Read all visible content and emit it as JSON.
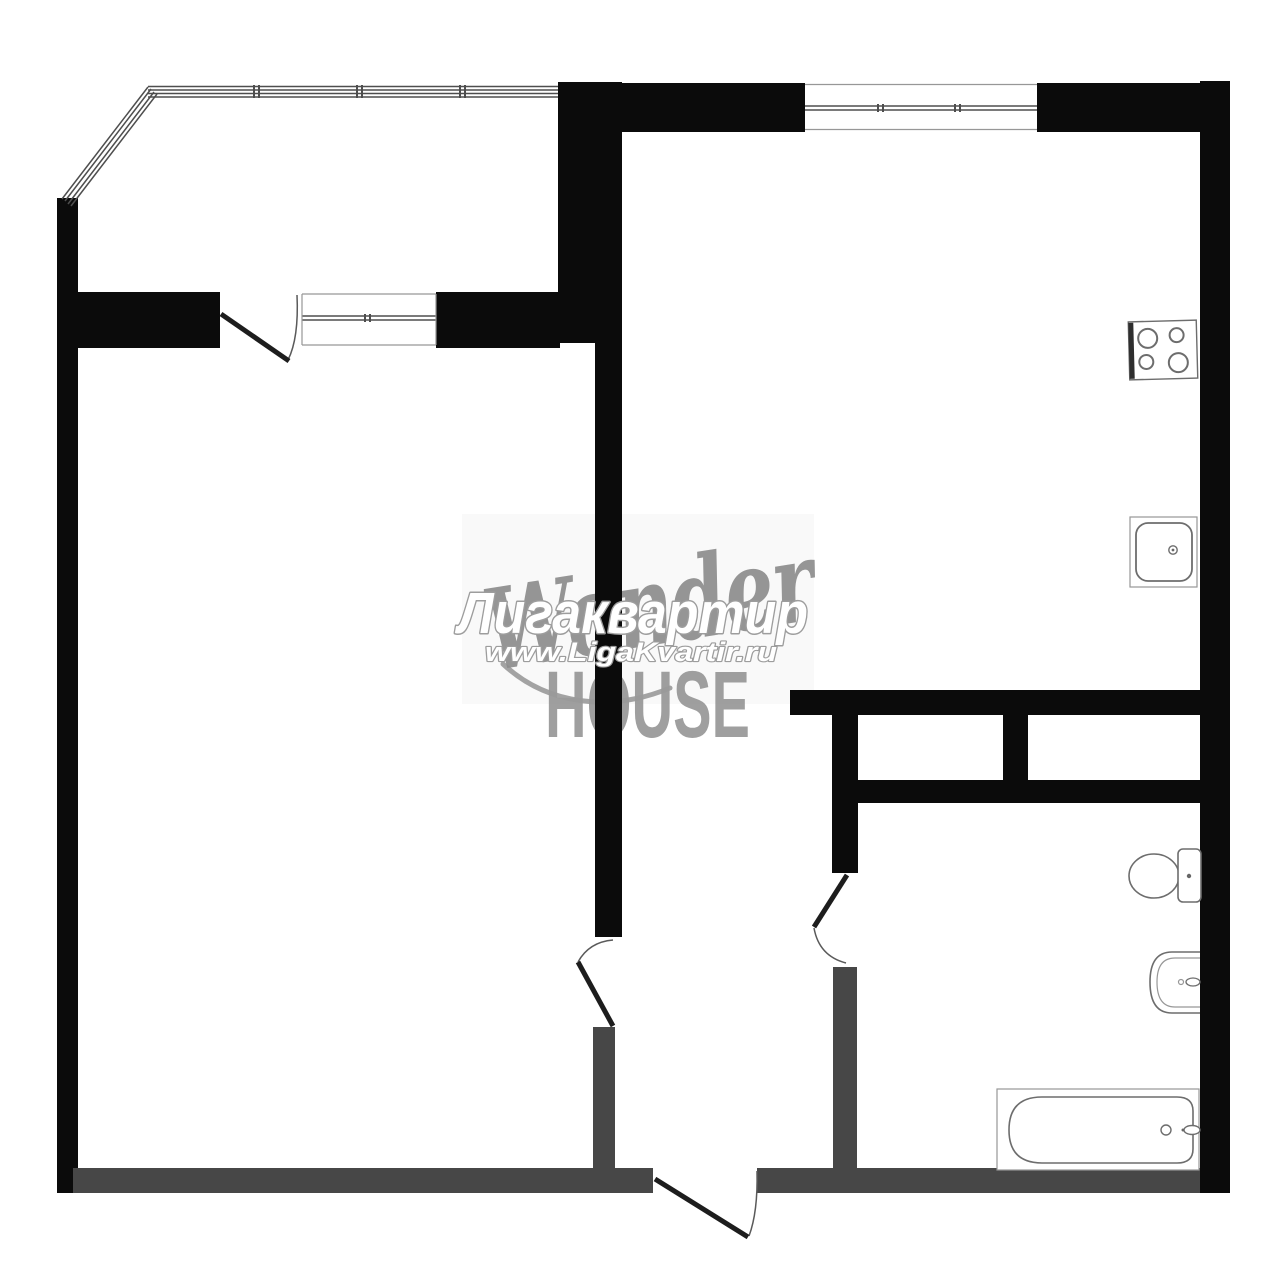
{
  "watermarks": {
    "agency_name": "Лигаквартир",
    "agency_url": "www.LigaKvartir.ru",
    "logo_script": "Wonder",
    "logo_block": "HOUSE"
  },
  "colors": {
    "wall": "#0b0b0b",
    "partition": "#474747",
    "door_leaf": "#1d1d1d",
    "window_line": "#4e4e4e",
    "thin_line": "#5a5a5a",
    "fixture_line": "#6d6d6d",
    "watermark_script": "#8d8d8d",
    "watermark_block": "#9a9a9a",
    "watermark_outline": "#9d9d9d",
    "watermark_fill": "#ffffff",
    "background": "#ffffff"
  },
  "icons": [
    "stove-icon",
    "kitchen-sink-icon",
    "toilet-icon",
    "washbasin-icon",
    "bathtub-icon",
    "balcony-window",
    "room-window",
    "kitchen-window",
    "balcony-door",
    "living-room-door",
    "bathroom-door",
    "entry-door"
  ]
}
